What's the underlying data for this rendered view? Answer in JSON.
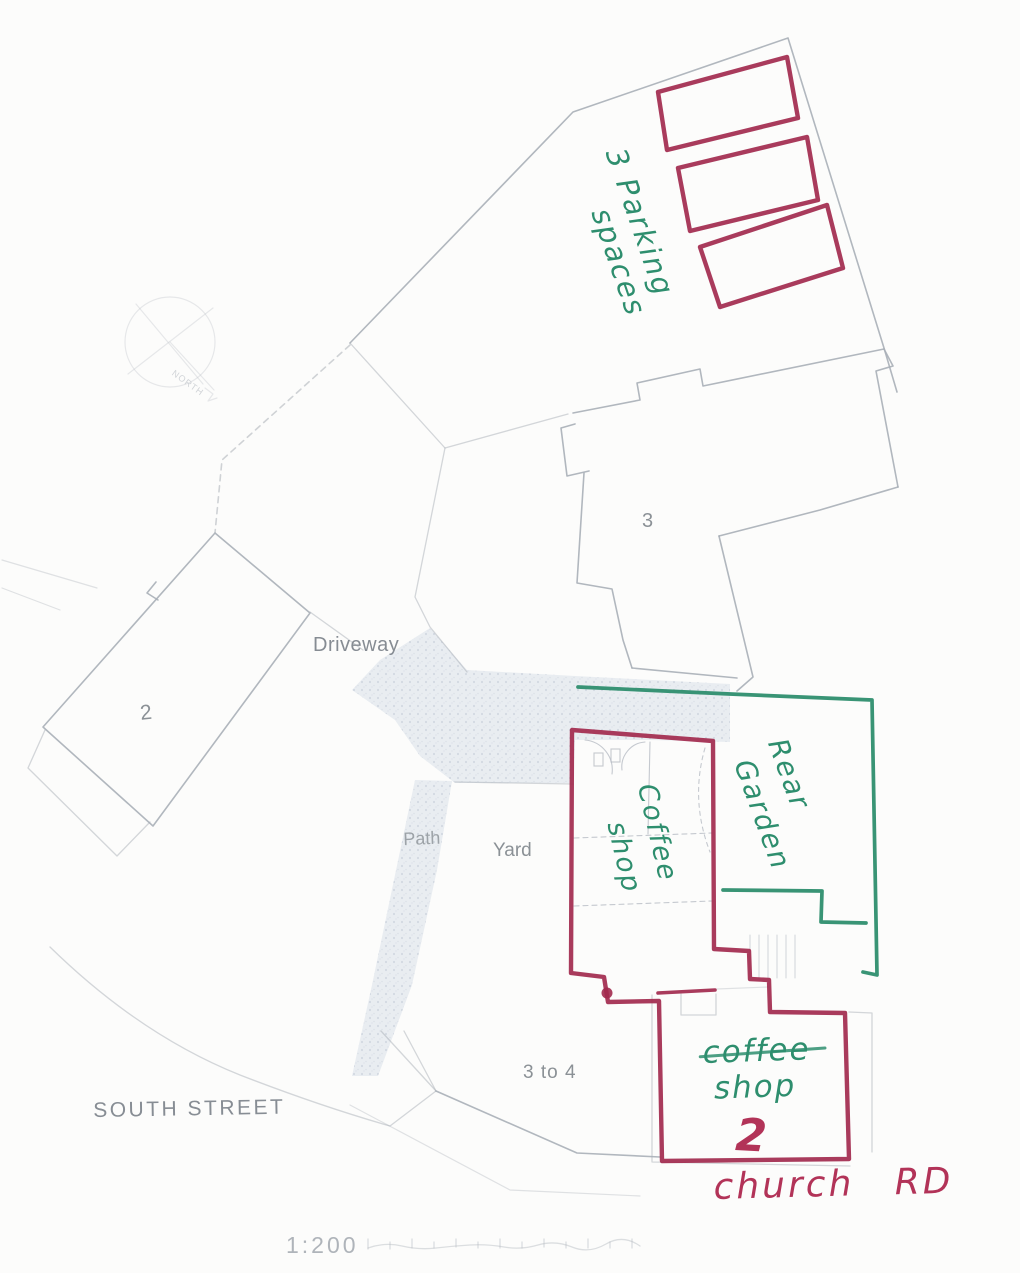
{
  "colors": {
    "red_pen": "#a22a4e",
    "red_pen_text": "#b23358",
    "green_pen": "#2e8e6e",
    "plan_line": "#a9afb7",
    "plan_text": "#8b9196",
    "shading": "#e4e9ef",
    "paper": "#fcfcfb"
  },
  "printed_labels": {
    "driveway": "Driveway",
    "building_2": "2",
    "building_3": "3",
    "path": "Path",
    "yard": "Yard",
    "three_to_four": "3 to 4",
    "south_street": "SOUTH STREET",
    "scale": "1:200",
    "north": "NORTH"
  },
  "handwritten_green": {
    "parking_line1": "3 Parking",
    "parking_line2": "spaces",
    "coffee_shop_upper_line1": "Coffee",
    "coffee_shop_upper_line2": "shop",
    "rear_garden_line1": "Rear",
    "rear_garden_line2": "Garden",
    "coffee_shop_lower_line1": "coffee",
    "coffee_shop_lower_line2": "shop"
  },
  "handwritten_red": {
    "church_road": "church RD",
    "shop_number": "2"
  }
}
